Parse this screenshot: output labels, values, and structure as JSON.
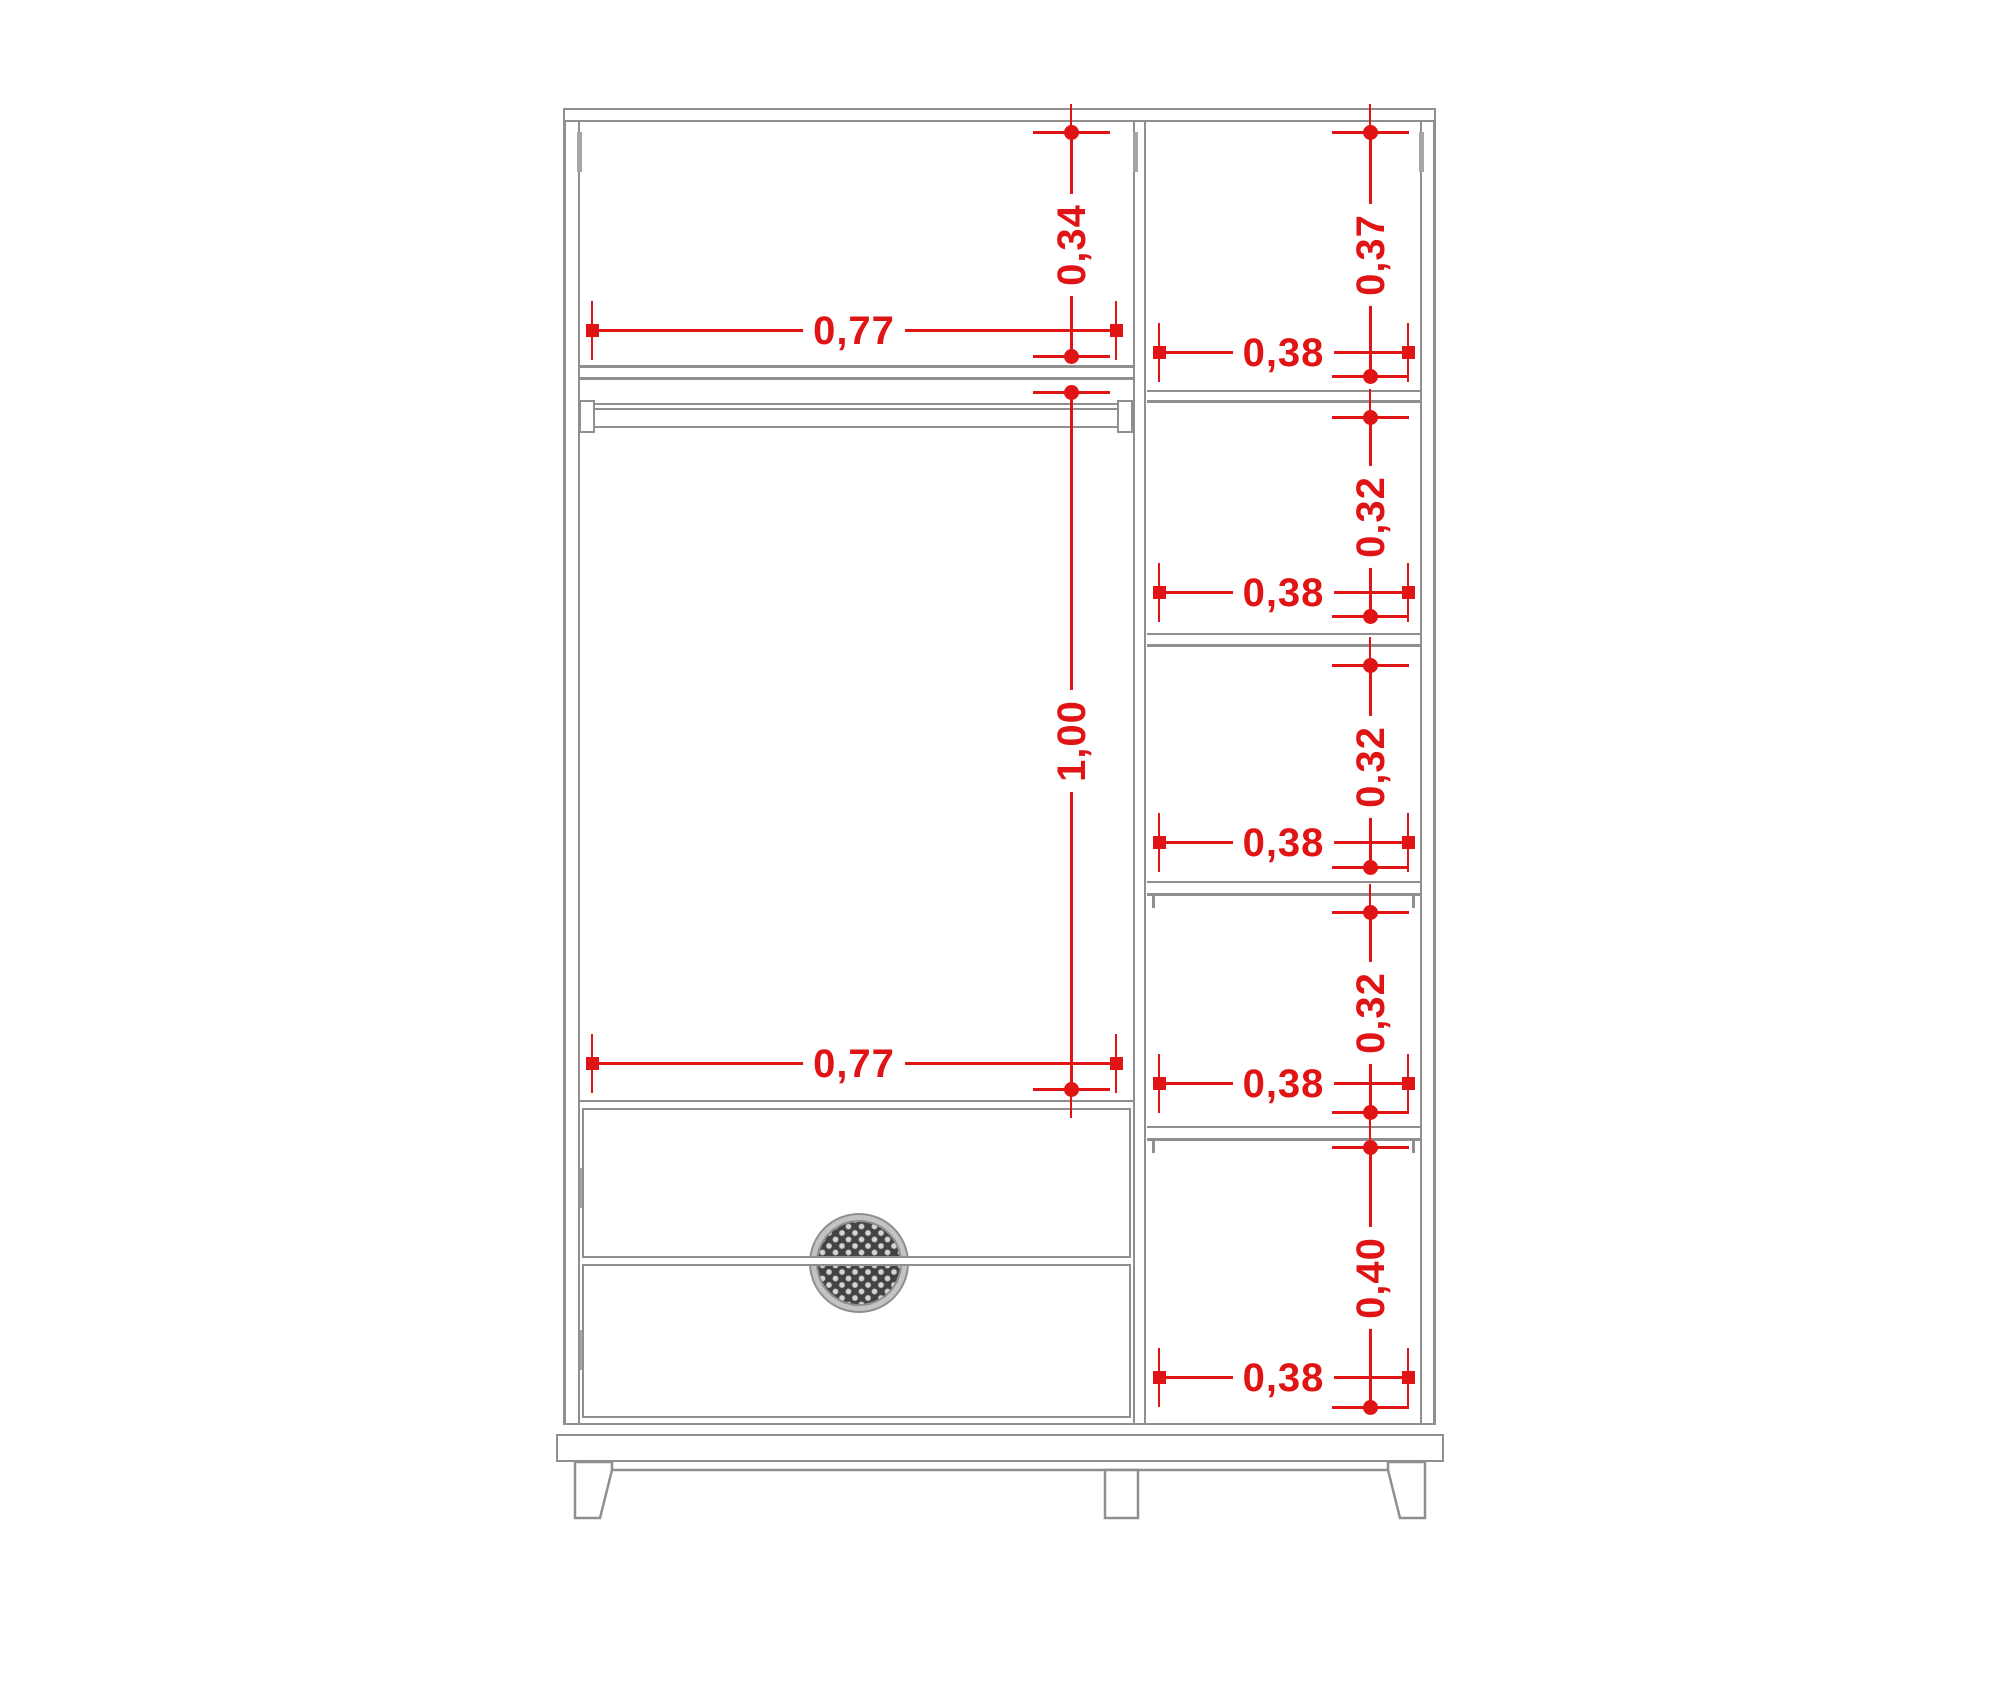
{
  "drawing": {
    "kind": "wardrobe-front-elevation",
    "colors": {
      "dimension": "#e01414",
      "structure_line": "#8f8f8f"
    },
    "left_section": {
      "top_compartment": {
        "width": "0,77",
        "height": "0,34"
      },
      "main_compartment": {
        "width": "0,77",
        "height": "1,00"
      }
    },
    "right_section": {
      "compartments": [
        {
          "height": "0,37",
          "width": "0,38"
        },
        {
          "height": "0,32",
          "width": "0,38"
        },
        {
          "height": "0,32",
          "width": "0,38"
        },
        {
          "height": "0,32",
          "width": "0,38"
        },
        {
          "height": "0,40",
          "width": "0,38"
        }
      ]
    }
  }
}
